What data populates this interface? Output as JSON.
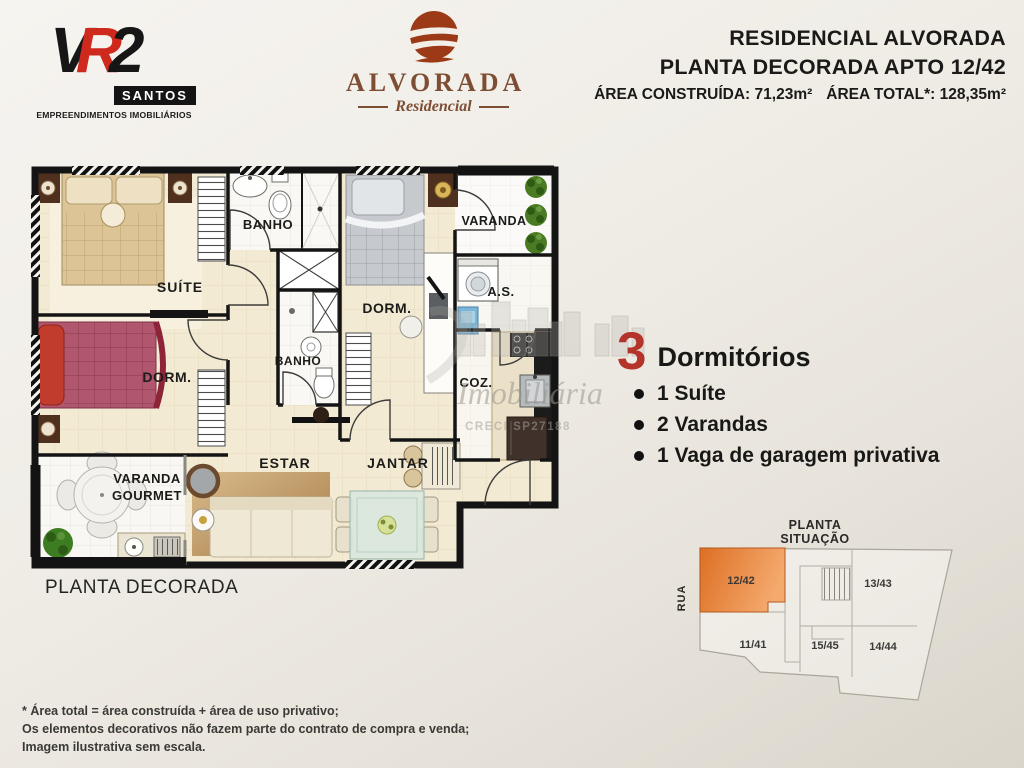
{
  "header": {
    "vr2_logo": {
      "letters": {
        "v": "V",
        "r": "R",
        "num": "2"
      },
      "city": "SANTOS",
      "tagline": "EMPREENDIMENTOS IMOBILIÁRIOS"
    },
    "alvorada_logo": {
      "name": "ALVORADA",
      "type": "Residencial"
    },
    "title_block": {
      "line1": "RESIDENCIAL ALVORADA",
      "line2": "PLANTA DECORADA APTO 12/42",
      "area_built": "ÁREA CONSTRUÍDA: 71,23m²",
      "area_total": "ÁREA TOTAL*: 128,35m²"
    }
  },
  "floor_plan": {
    "caption": "PLANTA DECORADA",
    "labels": {
      "suite": "SUÍTE",
      "dorm_left": "DORM.",
      "dorm_center": "DORM.",
      "banho_top": "BANHO",
      "banho_mid": "BANHO",
      "varanda": "VARANDA",
      "area_servico": "A.S.",
      "cozinha": "COZ.",
      "varanda_gourmet_line1": "VARANDA",
      "varanda_gourmet_line2": "GOURMET",
      "estar": "ESTAR",
      "jantar": "JANTAR"
    }
  },
  "features": {
    "count": "3",
    "count_label": "Dormitórios",
    "items": [
      "1 Suíte",
      "2 Varandas",
      "1 Vaga de garagem privativa"
    ]
  },
  "situation_plan": {
    "title_line1": "PLANTA",
    "title_line2": "SITUAÇÃO",
    "street_label": "RUA",
    "units": [
      {
        "label": "12/42",
        "highlighted": true
      },
      {
        "label": "13/43",
        "highlighted": false
      },
      {
        "label": "11/41",
        "highlighted": false
      },
      {
        "label": "15/45",
        "highlighted": false
      },
      {
        "label": "14/44",
        "highlighted": false
      }
    ]
  },
  "watermark": {
    "brand": "Imobiliária",
    "creci": "CRECI SP27188"
  },
  "footnotes": [
    "* Área total = área construída + área de uso privativo;",
    "Os elementos decorativos não fazem parte do contrato de compra e venda;",
    "Imagem ilustrativa sem escala."
  ],
  "colors": {
    "accent_red": "#c4281f",
    "logo_brown": "#7d4e33",
    "highlight_orange": "#e57e2d",
    "wall_black": "#141414",
    "floor_beige": "#f2ead3"
  }
}
